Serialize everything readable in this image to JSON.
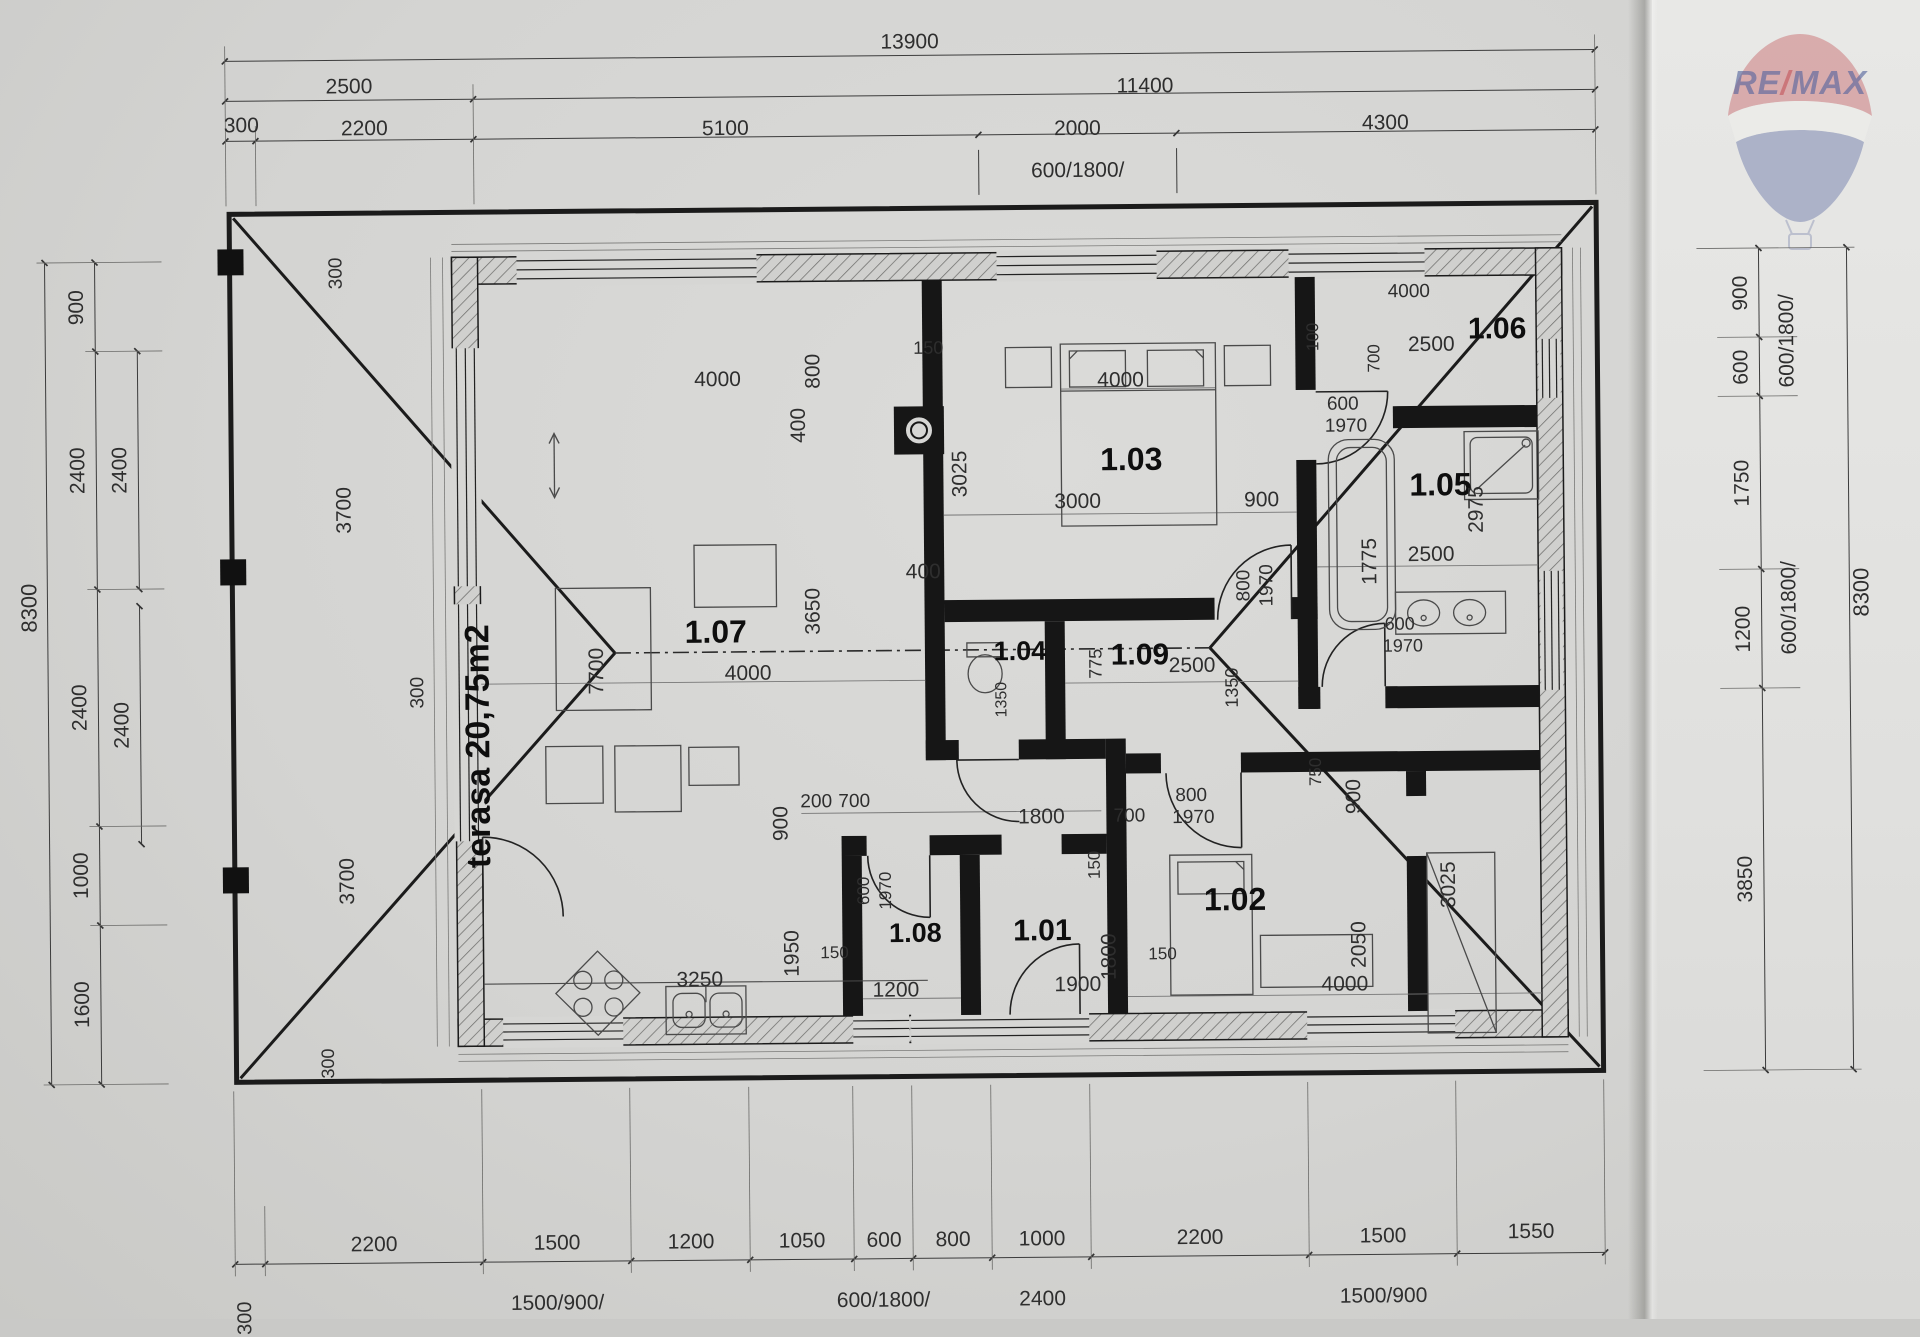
{
  "watermark": {
    "brand_re": "RE",
    "brand_slash": "/",
    "brand_max": "MAX",
    "red": "#c4575c",
    "blue": "#56659e"
  },
  "dimensions": {
    "top": {
      "total": "13900",
      "level2": [
        "2500",
        "11400"
      ],
      "level3": [
        "300",
        "2200",
        "5100",
        "2000",
        "4300"
      ],
      "openings": [
        "600/1800/"
      ]
    },
    "left": {
      "total": "8300",
      "chain": [
        "900",
        "2400",
        "2400",
        "1000",
        "1600"
      ],
      "inner": [
        "2400",
        "2400"
      ]
    },
    "right": {
      "total": "8300",
      "chain": [
        "900",
        "600",
        "1750",
        "1200",
        "3850"
      ],
      "openings": [
        "600/1800/",
        "600/1800/"
      ]
    },
    "bottom": {
      "chain": [
        "2200",
        "1500",
        "1200",
        "1050",
        "600",
        "800",
        "1000",
        "2200",
        "1500",
        "1550"
      ],
      "openings": [
        "1500/900/",
        "600/1800/",
        "2400",
        "1500/900"
      ],
      "edge": "300"
    }
  },
  "rooms": [
    {
      "id": "1.01"
    },
    {
      "id": "1.02"
    },
    {
      "id": "1.03"
    },
    {
      "id": "1.04"
    },
    {
      "id": "1.05"
    },
    {
      "id": "1.06"
    },
    {
      "id": "1.07"
    },
    {
      "id": "1.08"
    },
    {
      "id": "1.09"
    },
    {
      "id": "terasa",
      "area": "20,75m2"
    }
  ],
  "plan": {
    "labels": [
      {
        "t": "13900",
        "x": 915,
        "y": 42
      },
      {
        "t": "2500",
        "x": 354,
        "y": 82
      },
      {
        "t": "11400",
        "x": 1150,
        "y": 88
      },
      {
        "t": "300",
        "x": 246,
        "y": 120
      },
      {
        "t": "2200",
        "x": 369,
        "y": 124
      },
      {
        "t": "5100",
        "x": 730,
        "y": 127
      },
      {
        "t": "2000",
        "x": 1082,
        "y": 130
      },
      {
        "t": "4300",
        "x": 1390,
        "y": 127
      },
      {
        "t": "600/1800/",
        "x": 1082,
        "y": 172
      },
      {
        "t": "8300",
        "x": 30,
        "y": 600,
        "r": 1,
        "s": 22
      },
      {
        "t": "900",
        "x": 80,
        "y": 300,
        "r": 1
      },
      {
        "t": "2400",
        "x": 80,
        "y": 463,
        "r": 1
      },
      {
        "t": "2400",
        "x": 80,
        "y": 700,
        "r": 1
      },
      {
        "t": "1000",
        "x": 80,
        "y": 868,
        "r": 1
      },
      {
        "t": "1600",
        "x": 80,
        "y": 997,
        "r": 1
      },
      {
        "t": "2400",
        "x": 122,
        "y": 463,
        "r": 1
      },
      {
        "t": "2400",
        "x": 122,
        "y": 718,
        "r": 1
      },
      {
        "t": "900",
        "x": 1744,
        "y": 300,
        "r": 1
      },
      {
        "t": "600",
        "x": 1744,
        "y": 374,
        "r": 1
      },
      {
        "t": "1750",
        "x": 1744,
        "y": 490,
        "r": 1
      },
      {
        "t": "1200",
        "x": 1744,
        "y": 636,
        "r": 1
      },
      {
        "t": "3850",
        "x": 1744,
        "y": 886,
        "r": 1
      },
      {
        "t": "600/1800/",
        "x": 1790,
        "y": 348,
        "r": 1
      },
      {
        "t": "600/1800/",
        "x": 1790,
        "y": 615,
        "r": 1
      },
      {
        "t": "8300",
        "x": 1862,
        "y": 600,
        "r": 1,
        "s": 22
      },
      {
        "t": "2200",
        "x": 369,
        "y": 1240
      },
      {
        "t": "1500",
        "x": 552,
        "y": 1240
      },
      {
        "t": "1200",
        "x": 686,
        "y": 1240
      },
      {
        "t": "1050",
        "x": 797,
        "y": 1240
      },
      {
        "t": "600",
        "x": 879,
        "y": 1240
      },
      {
        "t": "800",
        "x": 948,
        "y": 1240
      },
      {
        "t": "1000",
        "x": 1037,
        "y": 1240
      },
      {
        "t": "2200",
        "x": 1195,
        "y": 1240
      },
      {
        "t": "1500",
        "x": 1378,
        "y": 1240
      },
      {
        "t": "1550",
        "x": 1526,
        "y": 1237
      },
      {
        "t": "1500/900/",
        "x": 552,
        "y": 1300
      },
      {
        "t": "600/1800/",
        "x": 878,
        "y": 1300
      },
      {
        "t": "2400",
        "x": 1037,
        "y": 1300
      },
      {
        "t": "1500/900",
        "x": 1378,
        "y": 1300
      },
      {
        "t": "300",
        "x": 240,
        "y": 1312,
        "r": 1,
        "s": 20
      },
      {
        "t": "300",
        "x": 340,
        "y": 268,
        "r": 1,
        "s": 19
      },
      {
        "t": "3700",
        "x": 346,
        "y": 505,
        "r": 1
      },
      {
        "t": "300",
        "x": 418,
        "y": 688,
        "r": 1,
        "s": 19
      },
      {
        "t": "3700",
        "x": 346,
        "y": 876,
        "r": 1
      },
      {
        "t": "300",
        "x": 325,
        "y": 1058,
        "r": 1,
        "s": 18
      },
      {
        "t": "terasa  20,75m2",
        "x": 478,
        "y": 742,
        "r": 1,
        "s": 34,
        "b": 1,
        "n": "terrace-label"
      },
      {
        "t": "1.07",
        "x": 716,
        "y": 630,
        "s": 32,
        "b": 1,
        "n": "room-label-1-07"
      },
      {
        "t": "7700",
        "x": 597,
        "y": 668,
        "r": 1
      },
      {
        "t": "4000",
        "x": 748,
        "y": 672
      },
      {
        "t": "3650",
        "x": 814,
        "y": 610,
        "r": 1
      },
      {
        "t": "4000",
        "x": 720,
        "y": 378
      },
      {
        "t": "800",
        "x": 816,
        "y": 370,
        "r": 1
      },
      {
        "t": "400",
        "x": 801,
        "y": 424,
        "r": 1
      },
      {
        "t": "150",
        "x": 931,
        "y": 348,
        "s": 18
      },
      {
        "t": "400",
        "x": 924,
        "y": 572
      },
      {
        "t": "3025",
        "x": 962,
        "y": 474,
        "r": 1
      },
      {
        "t": "1.03",
        "x": 1133,
        "y": 461,
        "s": 32,
        "b": 1,
        "n": "room-label-1-03"
      },
      {
        "t": "4000",
        "x": 1123,
        "y": 382
      },
      {
        "t": "3000",
        "x": 1079,
        "y": 503
      },
      {
        "t": "900",
        "x": 1263,
        "y": 503
      },
      {
        "t": "100",
        "x": 1316,
        "y": 340,
        "r": 1,
        "s": 17
      },
      {
        "t": "800",
        "x": 1245,
        "y": 588,
        "r": 1,
        "s": 19
      },
      {
        "t": "1970",
        "x": 1268,
        "y": 588,
        "r": 1,
        "s": 19
      },
      {
        "t": "1.06",
        "x": 1500,
        "y": 334,
        "s": 30,
        "b": 1,
        "n": "room-label-1-06"
      },
      {
        "t": "2500",
        "x": 1434,
        "y": 349
      },
      {
        "t": "4000",
        "x": 1412,
        "y": 296,
        "s": 19
      },
      {
        "t": "600",
        "x": 1345,
        "y": 408,
        "s": 19
      },
      {
        "t": "1970",
        "x": 1348,
        "y": 430,
        "s": 19
      },
      {
        "t": "700",
        "x": 1377,
        "y": 362,
        "r": 1,
        "s": 17
      },
      {
        "t": "1.05",
        "x": 1442,
        "y": 489,
        "s": 32,
        "b": 1,
        "n": "room-label-1-05"
      },
      {
        "t": "2975",
        "x": 1478,
        "y": 514,
        "r": 1
      },
      {
        "t": "2500",
        "x": 1432,
        "y": 559
      },
      {
        "t": "1775",
        "x": 1371,
        "y": 565,
        "r": 1
      },
      {
        "t": "600",
        "x": 1400,
        "y": 628,
        "s": 18
      },
      {
        "t": "1970",
        "x": 1403,
        "y": 650,
        "s": 18
      },
      {
        "t": "1.09",
        "x": 1140,
        "y": 657,
        "s": 30,
        "b": 1,
        "n": "room-label-1-09"
      },
      {
        "t": "2500",
        "x": 1192,
        "y": 668
      },
      {
        "t": "1350",
        "x": 1232,
        "y": 690,
        "r": 1,
        "s": 18
      },
      {
        "t": "775",
        "x": 1096,
        "y": 665,
        "r": 1,
        "s": 18
      },
      {
        "t": "1.04",
        "x": 1020,
        "y": 652,
        "s": 27,
        "b": 1,
        "n": "room-label-1-04"
      },
      {
        "t": "1350",
        "x": 1002,
        "y": 700,
        "r": 1,
        "s": 16
      },
      {
        "t": "900",
        "x": 780,
        "y": 822,
        "r": 1
      },
      {
        "t": "200",
        "x": 815,
        "y": 801,
        "s": 19
      },
      {
        "t": "700",
        "x": 853,
        "y": 801,
        "s": 19
      },
      {
        "t": "1800",
        "x": 1040,
        "y": 818
      },
      {
        "t": "700",
        "x": 1128,
        "y": 818,
        "s": 19
      },
      {
        "t": "150",
        "x": 1093,
        "y": 866,
        "r": 1,
        "s": 17
      },
      {
        "t": "800",
        "x": 1190,
        "y": 798,
        "s": 19
      },
      {
        "t": "1970",
        "x": 1192,
        "y": 820,
        "s": 19
      },
      {
        "t": "900",
        "x": 1353,
        "y": 800,
        "r": 1
      },
      {
        "t": "750",
        "x": 1315,
        "y": 775,
        "r": 1,
        "s": 17
      },
      {
        "t": "600",
        "x": 862,
        "y": 890,
        "r": 1,
        "s": 17
      },
      {
        "t": "1970",
        "x": 884,
        "y": 890,
        "r": 1,
        "s": 17
      },
      {
        "t": "1.08",
        "x": 913,
        "y": 933,
        "s": 27,
        "b": 1,
        "n": "room-label-1-08"
      },
      {
        "t": "1950",
        "x": 790,
        "y": 952,
        "r": 1
      },
      {
        "t": "150",
        "x": 832,
        "y": 952,
        "s": 17
      },
      {
        "t": "1200",
        "x": 893,
        "y": 990
      },
      {
        "t": "3250",
        "x": 697,
        "y": 978
      },
      {
        "t": "1.01",
        "x": 1040,
        "y": 932,
        "s": 30,
        "b": 1,
        "n": "room-label-1-01"
      },
      {
        "t": "1900",
        "x": 1075,
        "y": 986
      },
      {
        "t": "1800",
        "x": 1107,
        "y": 958,
        "r": 1
      },
      {
        "t": "150",
        "x": 1160,
        "y": 956,
        "s": 17
      },
      {
        "t": "1.02",
        "x": 1233,
        "y": 902,
        "s": 32,
        "b": 1,
        "n": "room-label-1-02"
      },
      {
        "t": "2050",
        "x": 1357,
        "y": 948,
        "r": 1
      },
      {
        "t": "4000",
        "x": 1342,
        "y": 988
      },
      {
        "t": "3025",
        "x": 1447,
        "y": 889,
        "r": 1
      }
    ]
  }
}
